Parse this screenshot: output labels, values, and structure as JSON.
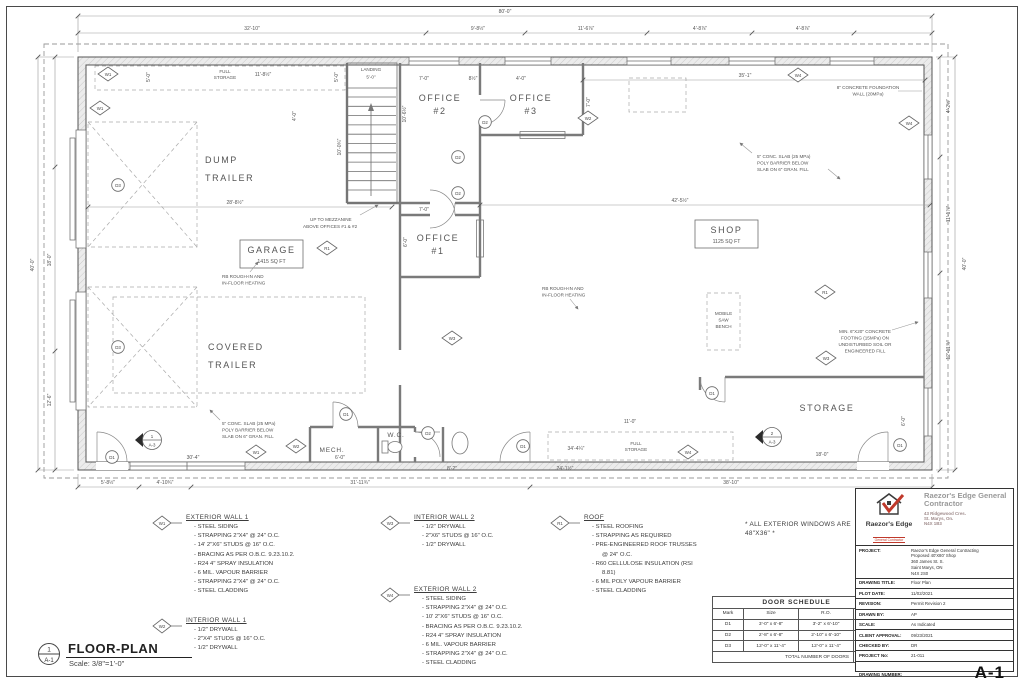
{
  "sheet": {
    "drawing_number": "A-1",
    "view_number": "1",
    "view_sheet": "A-1",
    "view_title": "FLOOR-PLAN",
    "view_scale": "Scale: 3/8\"=1'-0\""
  },
  "title_block": {
    "logo_text": "Raezor's Edge",
    "logo_sub": "General Contractor",
    "company_name": "Raezor's Edge General Contractor",
    "address_line1": "43 Ridgewood Cres.",
    "address_line2": "St. Marys, On.",
    "address_line3": "N4X 1B3",
    "project_label": "PROJECT:",
    "project_lines": [
      "Raezor's Edge General Contracting",
      "Proposed 40'X80' Shop",
      "360 James St. S.",
      "Saint Marys, ON",
      "N4X 2S0"
    ],
    "drawing_title_label": "DRAWING TITLE:",
    "drawing_title": "Floor Plan",
    "rows": [
      {
        "label": "PLOT DATE:",
        "value": "11/02/2021"
      },
      {
        "label": "REVISION:",
        "value": "Permit Revision 2"
      },
      {
        "label": "DRAWN BY:",
        "value": "AP"
      },
      {
        "label": "SCALE:",
        "value": "As Indicated"
      },
      {
        "label": "CLIENT APPROVAL:",
        "value": "09/23/2021"
      },
      {
        "label": "CHECKED BY:",
        "value": "DR"
      },
      {
        "label": "PROJECT No:",
        "value": "21-011"
      }
    ],
    "drawing_number_label": "DRAWING NUMBER:"
  },
  "windows_note": "* ALL EXTERIOR WINDOWS ARE 48\"X36\" *",
  "door_schedule": {
    "title": "DOOR SCHEDULE",
    "headers": [
      "Mark",
      "Size",
      "R.O.",
      "Qty."
    ],
    "rows": [
      [
        "D1",
        "3'-0\" x 6'-8\"",
        "3'-2\" x 6'-10\"",
        "5"
      ],
      [
        "D2",
        "2'-8\" x 6'-8\"",
        "2'-10\" x 6'-10\"",
        "4"
      ],
      [
        "D3",
        "12'-0\" x 11'-4\"",
        "12'-0\" x 11'-4\"",
        "2"
      ]
    ],
    "total_label": "TOTAL NUMBER OF DOORS",
    "total": "11"
  },
  "legend": [
    {
      "tag": "W1",
      "title": "EXTERIOR WALL 1",
      "items": [
        "STEEL SIDING",
        "STRAPPING 2\"X4\" @ 24\" O.C.",
        "14' 2\"X6\" STUDS @ 16\" O.C.",
        "BRACING AS PER O.B.C. 9.23.10.2.",
        "R24 4\" SPRAY INSULATION",
        "6 MIL. VAPOUR BARRIER",
        "STRAPPING 2\"X4\" @ 24\" O.C.",
        "STEEL CLADDING"
      ]
    },
    {
      "tag": "W2",
      "title": "INTERIOR WALL 1",
      "items": [
        "1/2\" DRYWALL",
        "2\"X4\" STUDS @ 16\" O.C.",
        "1/2\" DRYWALL"
      ]
    },
    {
      "tag": "W3",
      "title": "INTERIOR WALL 2",
      "items": [
        "1/2\" DRYWALL",
        "2\"X6\" STUDS @ 16\" O.C.",
        "1/2\" DRYWALL"
      ]
    },
    {
      "tag": "W4",
      "title": "EXTERIOR WALL 2",
      "items": [
        "STEEL SIDING",
        "STRAPPING 2\"X4\" @ 24\" O.C.",
        "10' 2\"X6\" STUDS @ 16\" O.C.",
        "BRACING AS PER O.B.C. 9.23.10.2.",
        "R24 4\" SPRAY INSULATION",
        "6 MIL. VAPOUR BARRIER",
        "STRAPPING 2\"X4\" @ 24\" O.C.",
        "STEEL CLADDING"
      ]
    },
    {
      "tag": "R1",
      "title": "ROOF",
      "items": [
        "STEEL ROOFING",
        "STRAPPING AS REQUIRED",
        "PRE-ENGINEERED ROOF TRUSSES @ 24\" O.C.",
        "R60 CELLULOSE INSULATION (RSI 8.81)",
        "6 MIL POLY VAPOUR BARRIER",
        "STEEL CLADDING"
      ]
    }
  ],
  "plan": {
    "rooms": {
      "dump1": "DUMP",
      "dump2": "TRAILER",
      "cov1": "COVERED",
      "cov2": "TRAILER",
      "garage": "GARAGE",
      "garage_area": "1415 SQ FT",
      "shop": "SHOP",
      "shop_area": "1125 SQ FT",
      "office": "OFFICE",
      "o1": "#1",
      "o2": "#2",
      "o3": "#3",
      "storage": "STORAGE",
      "mech": "MECH.",
      "wc": "W.C.",
      "landing": "LANDING"
    },
    "door_marks": {
      "d1": "D1",
      "d2": "D2",
      "d3": "D3"
    },
    "wall_marks": {
      "w1": "W1",
      "w2": "W2",
      "w3": "W3",
      "w4": "W4",
      "r1": "R1"
    },
    "sections": {
      "s1_num": "1",
      "s1_sheet": "A-3",
      "s2_num": "2",
      "s2_sheet": "A-3"
    },
    "dims": {
      "overall_w": "80'-0\"",
      "seg_left": "32'-10\"",
      "seg_a": "9'-8½\"",
      "seg_b": "11'-6⅞\"",
      "seg_c": "4'-8⅞\"",
      "seg_d": "4'-8⅞\"",
      "left_h": "40'-0\"",
      "left_a": "18'-0\"",
      "left_b": "12'-6\"",
      "right_h": "40'-0\"",
      "right_a": "4'-2½\"",
      "right_b": "11'-1⅞\"",
      "right_c": "12'-11⅞\"",
      "bot_a": "5'-8½\"",
      "bot_b": "4'-10¾\"",
      "bot_c": "31'-11¾\"",
      "bot_d": "38'-10\"",
      "dump_w": "28'-8½\"",
      "garage_w": "30'-4\"",
      "shop_w": "42'-5½\"",
      "shop_top_w": "35'-1\"",
      "fs_top_w": "11'-8½\"",
      "fs_top_d1": "5'-0\"",
      "fs_top_d2": "5'-0\"",
      "landing_w": "5'-0\"",
      "stair_w": "4'-0\"",
      "stair_h": "10'-0¾\"",
      "off2_w": "7'-0\"",
      "off_jamb": "8½\"",
      "off3_w": "4'-0\"",
      "off3_d": "7'-0\"",
      "off2_d": "10'-6½\"",
      "off1_w": "7'-0\"",
      "off1_d": "6'-0\"",
      "mech_w": "6'-0\"",
      "wc_w": "8'-2\"",
      "mid_w": "24'-1½\"",
      "stor_w": "18'-0\"",
      "stor_d": "6'-0\"",
      "fs_bot_w": "11'-0\"",
      "fs_bot_l": "34'-4¼\""
    },
    "notes": {
      "slab": [
        "5\" CONC. SLAB (25 MPa)",
        "POLY BARRIER BELOW",
        "SLAB ON 6\" GRAN. FILL"
      ],
      "foundation": [
        "8\" CONCRETE FOUNDATION",
        "WALL (20MPa)"
      ],
      "footing": [
        "MIN. 6\"X20\" CONCRETE",
        "FOOTING (15MPa) ON",
        "UNDISTURBED SOIL OR",
        "ENGINEERED FILL"
      ],
      "heating": [
        "RB ROUGH-IN AND",
        "IN-FLOOR HEATING"
      ],
      "mezz": [
        "UP TO MEZZANINE",
        "ABOVE OFFICES #1 & #2"
      ],
      "saw": [
        "MOBILE",
        "SAW",
        "BENCH"
      ],
      "full_storage1": "FULL",
      "full_storage2": "STORAGE"
    }
  },
  "colors": {
    "accent_red": "#c0392b",
    "line_gray": "#6e6e6e",
    "muted_gray": "#9a9a9a"
  }
}
